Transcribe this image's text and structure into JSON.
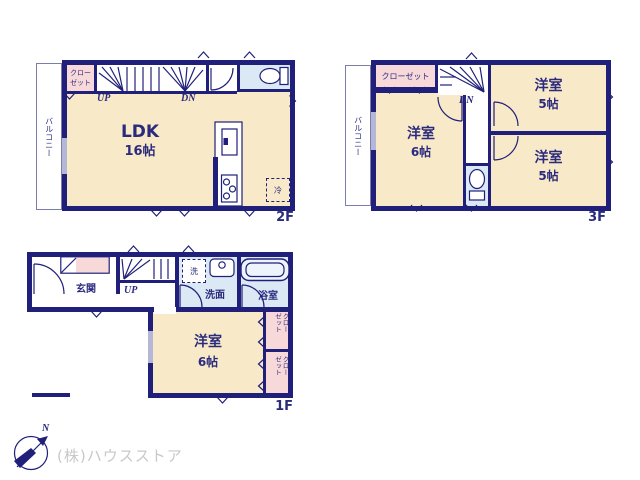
{
  "colors": {
    "wall": "#20207a",
    "room": "#f8e9c8",
    "closet": "#f8d9da",
    "wet": "#dbe9f4",
    "window": "#b4b8d6",
    "text": "#2b2b7e",
    "balcony_line": "#7d7dab",
    "company": "#c8c8c8"
  },
  "f2": {
    "floor_label": "2F",
    "balcony": "バルコニー",
    "closet": "クロー\nゼット",
    "up": "UP",
    "dn": "DN",
    "room_name": "LDK",
    "room_size": "16帖",
    "fridge": "冷"
  },
  "f3": {
    "floor_label": "3F",
    "balcony": "バルコニー",
    "closet": "クローゼット",
    "dn": "DN",
    "room_west_name": "洋室",
    "room_west_size": "6帖",
    "room_ne_name": "洋室",
    "room_ne_size": "5帖",
    "room_se_name": "洋室",
    "room_se_size": "5帖"
  },
  "f1": {
    "floor_label": "1F",
    "entrance": "玄関",
    "up": "UP",
    "laundry": "洗",
    "washroom": "洗面",
    "bathroom": "浴室",
    "room_name": "洋室",
    "room_size": "6帖",
    "closet_upper": "クロー\nゼット",
    "closet_lower": "クロー\nゼット"
  },
  "compass": {
    "north": "N"
  },
  "footer": {
    "company": "(株)ハウスストア"
  }
}
